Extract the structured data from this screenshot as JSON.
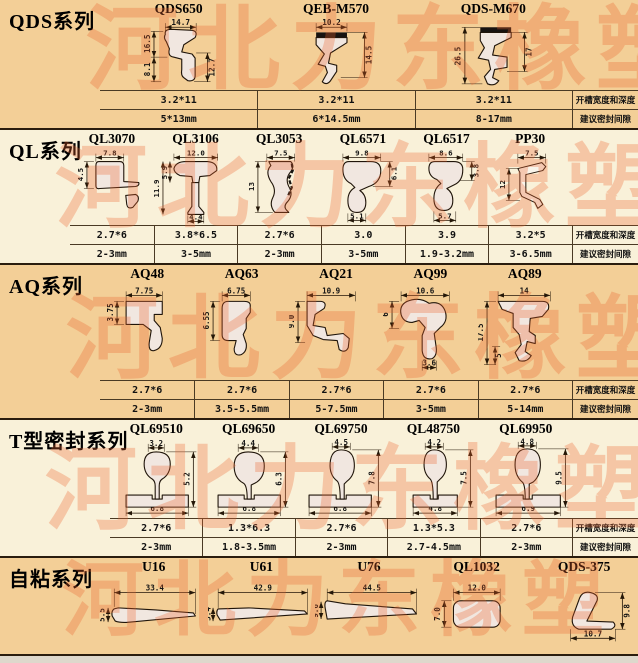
{
  "watermark": "河北力东橡塑",
  "column_labels": {
    "groove": "开槽宽度和深度",
    "gap": "建议密封间隙"
  },
  "sections": [
    {
      "title": "QDS系列",
      "products": [
        {
          "name": "QDS650",
          "groove": "3.2*11",
          "gap": "5*13mm",
          "dims": {
            "top": "14.7",
            "left": "16.5",
            "left2": "8.1",
            "right": "12.7"
          }
        },
        {
          "name": "QEB-M570",
          "groove": "3.2*11",
          "gap": "6*14.5mm",
          "dims": {
            "top": "10.2",
            "right": "14.5"
          }
        },
        {
          "name": "QDS-M670",
          "groove": "3.2*11",
          "gap": "8-17mm",
          "dims": {
            "left": "26.5",
            "right": "17"
          }
        }
      ]
    },
    {
      "title": "QL系列",
      "products": [
        {
          "name": "QL3070",
          "groove": "2.7*6",
          "gap": "2-3mm",
          "dims": {
            "top": "7.8",
            "left": "4.5"
          }
        },
        {
          "name": "QL3106",
          "groove": "3.8*6.5",
          "gap": "3-5mm",
          "dims": {
            "top": "12.0",
            "left": "11.9",
            "left2": "5.9",
            "bottom": "4.4"
          }
        },
        {
          "name": "QL3053",
          "groove": "2.7*6",
          "gap": "2-3mm",
          "dims": {
            "top": "7.5",
            "left": "13"
          }
        },
        {
          "name": "QL6571",
          "groove": "3.0",
          "gap": "3-5mm",
          "dims": {
            "top": "9.8",
            "right": "6.1",
            "bottom": "5.1"
          }
        },
        {
          "name": "QL6517",
          "groove": "3.9",
          "gap": "1.9-3.2mm",
          "dims": {
            "top": "8.6",
            "right": "3.8",
            "bottom": "5.7"
          }
        },
        {
          "name": "PP30",
          "groove": "3.2*5",
          "gap": "3-6.5mm",
          "dims": {
            "top": "7.5",
            "left": "12"
          }
        }
      ]
    },
    {
      "title": "AQ系列",
      "products": [
        {
          "name": "AQ48",
          "groove": "2.7*6",
          "gap": "2-3mm",
          "dims": {
            "top": "7.75",
            "left": "3.75"
          }
        },
        {
          "name": "AQ63",
          "groove": "2.7*6",
          "gap": "3.5-5.5mm",
          "dims": {
            "top": "6.75",
            "left": "6.55"
          }
        },
        {
          "name": "AQ21",
          "groove": "2.7*6",
          "gap": "5-7.5mm",
          "dims": {
            "top": "10.9",
            "left": "9.0"
          }
        },
        {
          "name": "AQ99",
          "groove": "2.7*6",
          "gap": "3-5mm",
          "dims": {
            "top": "10.6",
            "left": "6",
            "bottom": "3.6"
          }
        },
        {
          "name": "AQ89",
          "groove": "2.7*6",
          "gap": "5-14mm",
          "dims": {
            "top": "14",
            "left": "17.5",
            "left2": "5"
          }
        }
      ]
    },
    {
      "title": "T型密封系列",
      "products": [
        {
          "name": "QL69510",
          "groove": "2.7*6",
          "gap": "2-3mm",
          "dims": {
            "top": "3.2",
            "right": "5.2",
            "bottom": "6.8"
          }
        },
        {
          "name": "QL69650",
          "groove": "1.3*6.3",
          "gap": "1.8-3.5mm",
          "dims": {
            "top": "4.4",
            "right": "6.3",
            "bottom": "6.8"
          }
        },
        {
          "name": "QL69750",
          "groove": "2.7*6",
          "gap": "2-3mm",
          "dims": {
            "top": "4.5",
            "right": "7.8",
            "bottom": "6.8"
          }
        },
        {
          "name": "QL48750",
          "groove": "1.3*5.3",
          "gap": "2.7-4.5mm",
          "dims": {
            "top": "4.2",
            "right": "7.5",
            "bottom": "4.8"
          }
        },
        {
          "name": "QL69950",
          "groove": "2.7*6",
          "gap": "2-3mm",
          "dims": {
            "top": "4.8",
            "right": "9.5",
            "bottom": "6.9"
          }
        }
      ]
    },
    {
      "title": "自粘系列",
      "products": [
        {
          "name": "U16",
          "dims": {
            "top": "33.4",
            "left": "5.5"
          }
        },
        {
          "name": "U61",
          "dims": {
            "top": "42.9",
            "left": "5.4"
          }
        },
        {
          "name": "U76",
          "dims": {
            "top": "44.5",
            "left": "9.6"
          }
        },
        {
          "name": "QL1032",
          "dims": {
            "top": "12.0",
            "left": "7.0"
          }
        },
        {
          "name": "QDS-375",
          "dims": {
            "right": "9.8",
            "bottom": "10.7"
          }
        }
      ]
    }
  ]
}
